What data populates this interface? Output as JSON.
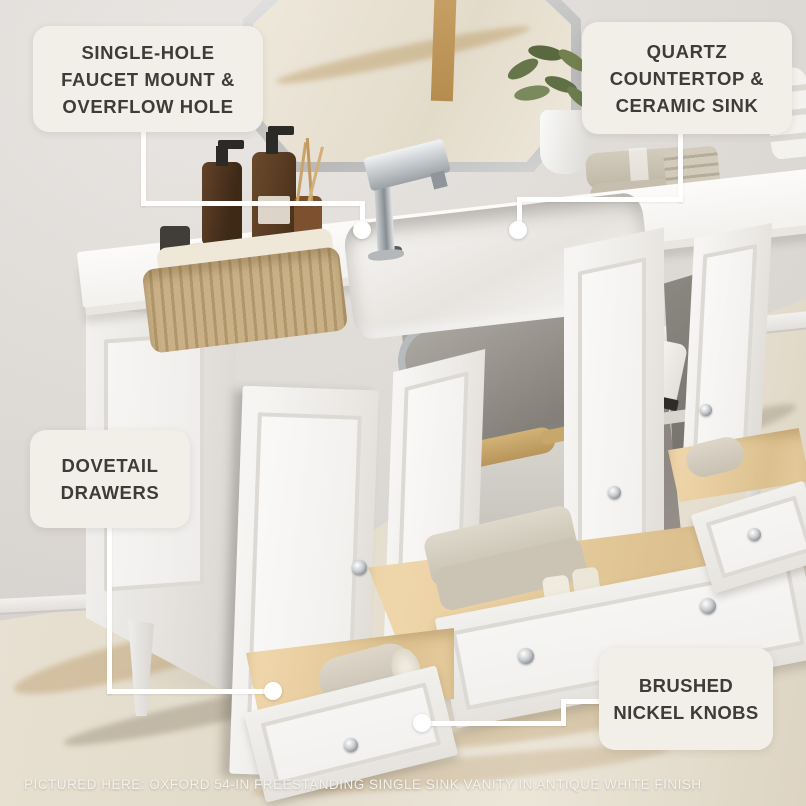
{
  "callouts": {
    "faucet": {
      "lines": [
        "SINGLE-HOLE",
        "FAUCET MOUNT &",
        "OVERFLOW HOLE"
      ]
    },
    "countertop": {
      "lines": [
        "QUARTZ",
        "COUNTERTOP &",
        "CERAMIC SINK"
      ]
    },
    "drawers": {
      "lines": [
        "DOVETAIL",
        "DRAWERS"
      ]
    },
    "knobs": {
      "lines": [
        "BRUSHED",
        "NICKEL KNOBS"
      ]
    }
  },
  "caption": {
    "text": "PICTURED HERE: OXFORD 54-IN FREESTANDING SINGLE SINK VANITY IN ANTIQUE WHITE FINISH"
  },
  "colors": {
    "callout_bg": "#f2efe9",
    "callout_text": "#3e3c39",
    "connector": "#ffffff",
    "caption_text": "#f2f1ee",
    "wall": "#ddd9d5",
    "floor_marble": "#e8e1d3",
    "marble_vein": "#b98f4a",
    "vanity_white": "#efedea",
    "drawer_wood": "#e6cb9d",
    "chrome_nickel": "#b9bdc0",
    "amber_bottle": "#5d3f26",
    "basket_tan": "#bfa67a",
    "towel_beige": "#c9c1b1",
    "plant_green": "#6d7c4f"
  }
}
